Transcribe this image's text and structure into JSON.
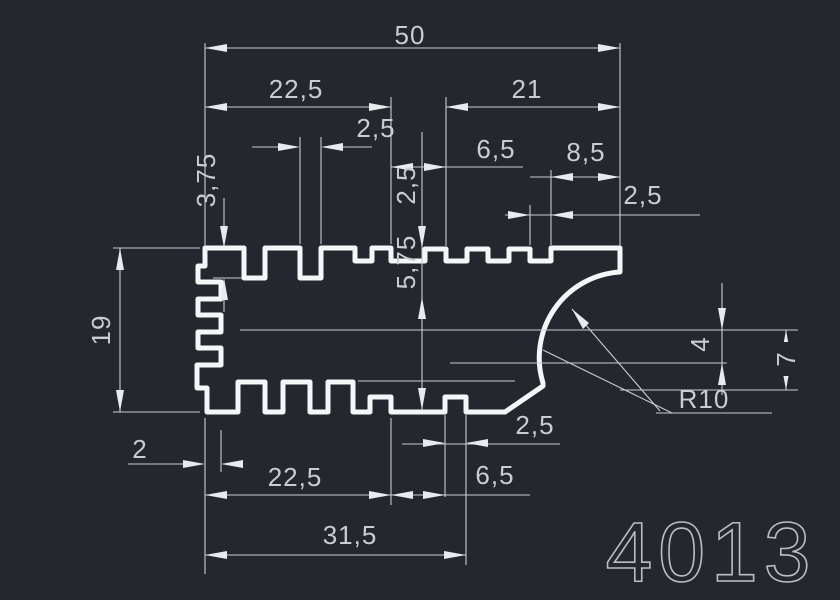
{
  "drawing": {
    "part_number": "4013",
    "colors": {
      "background": "#24282e",
      "profile_line": "#f4f6f8",
      "dimension_line": "#c9cdd3",
      "part_number_text": "#b9bec5"
    },
    "dims": {
      "overall_width": "50",
      "top_left_section": "22,5",
      "top_right_section": "21",
      "fin_notch_width": "2,5",
      "top_middle_gap": "6,5",
      "right_lip_width": "8,5",
      "right_tooth_gap": "2,5",
      "fin_depth": "3,75",
      "step_depth": "2,5",
      "mid_depth": "5,75",
      "overall_height": "19",
      "left_edge_step": "2",
      "bottom_left_section": "22,5",
      "bottom_mid_section": "31,5",
      "bottom_gap": "6,5",
      "bottom_tooth_width": "2,5",
      "curve_drop_upper": "4",
      "curve_drop_lower": "7",
      "corner_radius": "R10"
    }
  }
}
